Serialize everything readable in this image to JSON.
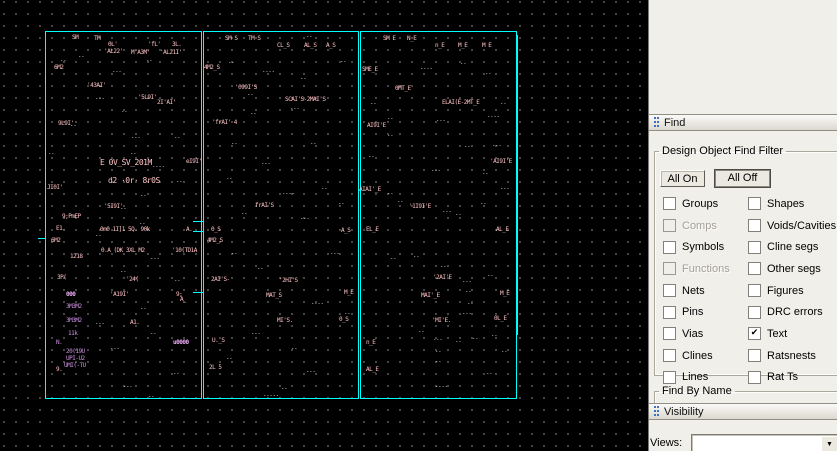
{
  "find": {
    "title": "Find",
    "group_title": "Design Object Find Filter",
    "all_on": "All On",
    "all_off": "All Off",
    "check_glyph": "✔",
    "rows": [
      {
        "left": {
          "label": "Groups",
          "checked": false
        },
        "right": {
          "label": "Shapes",
          "checked": false
        }
      },
      {
        "left": {
          "label": "Comps",
          "checked": false,
          "disabled": true
        },
        "right": {
          "label": "Voids/Cavities",
          "checked": false
        }
      },
      {
        "left": {
          "label": "Symbols",
          "checked": false
        },
        "right": {
          "label": "Cline segs",
          "checked": false
        }
      },
      {
        "left": {
          "label": "Functions",
          "checked": false,
          "disabled": true
        },
        "right": {
          "label": "Other segs",
          "checked": false
        }
      },
      {
        "left": {
          "label": "Nets",
          "checked": false
        },
        "right": {
          "label": "Figures",
          "checked": false
        }
      },
      {
        "left": {
          "label": "Pins",
          "checked": false
        },
        "right": {
          "label": "DRC errors",
          "checked": false
        }
      },
      {
        "left": {
          "label": "Vias",
          "checked": false
        },
        "right": {
          "label": "Text",
          "checked": true
        }
      },
      {
        "left": {
          "label": "Clines",
          "checked": false
        },
        "right": {
          "label": "Ratsnests",
          "checked": false
        }
      },
      {
        "left": {
          "label": "Lines",
          "checked": false
        },
        "right": {
          "label": "Rat Ts",
          "checked": false
        }
      }
    ],
    "find_by_name": "Find By Name"
  },
  "visibility": {
    "title": "Visibility",
    "views_label": "Views:",
    "views_value": ""
  },
  "canvas": {
    "bg": "#000000",
    "grid_dot_color": "#9f9f9f",
    "outline_color": "#00ffff",
    "rects": [
      {
        "x": 45,
        "y": 31,
        "w": 155,
        "h": 366
      },
      {
        "x": 203,
        "y": 31,
        "w": 154,
        "h": 366
      },
      {
        "x": 360,
        "y": 31,
        "w": 155,
        "h": 366
      }
    ],
    "ticks": [
      {
        "x": 193,
        "y": 221,
        "w": 10,
        "h": 1
      },
      {
        "x": 193,
        "y": 231,
        "w": 10,
        "h": 1
      },
      {
        "x": 193,
        "y": 292,
        "w": 10,
        "h": 1
      },
      {
        "x": 38,
        "y": 238,
        "w": 8,
        "h": 1
      },
      {
        "x": 517,
        "y": 35,
        "w": 1,
        "h": 300
      }
    ],
    "texts": [
      {
        "x": 72,
        "y": 35,
        "t": "SM",
        "c": "pink"
      },
      {
        "x": 94,
        "y": 36,
        "t": "TM",
        "c": "pink"
      },
      {
        "x": 108,
        "y": 42,
        "t": "0L'",
        "c": "pink"
      },
      {
        "x": 148,
        "y": 42,
        "t": "'fL'",
        "c": "pink"
      },
      {
        "x": 172,
        "y": 42,
        "t": "3L.",
        "c": "pink"
      },
      {
        "x": 104,
        "y": 49,
        "t": "'AL22'",
        "c": "pink"
      },
      {
        "x": 131,
        "y": 50,
        "t": "M'A3M'",
        "c": "pink"
      },
      {
        "x": 160,
        "y": 50,
        "t": "'AL21I'",
        "c": "pink"
      },
      {
        "x": 54,
        "y": 65,
        "t": "6M2",
        "c": "pink"
      },
      {
        "x": 87,
        "y": 83,
        "t": "'43AI'",
        "c": "pink"
      },
      {
        "x": 138,
        "y": 95,
        "t": "'5L9I'",
        "c": "pink"
      },
      {
        "x": 157,
        "y": 100,
        "t": "2I'AI'",
        "c": "pink"
      },
      {
        "x": 58,
        "y": 121,
        "t": "9L9I'",
        "c": "pink"
      },
      {
        "x": 100,
        "y": 160,
        "t": "E 0V_SV_201M",
        "c": "pink",
        "s": 8
      },
      {
        "x": 108,
        "y": 178,
        "t": "d2 ·0r· 8r0S",
        "c": "pink",
        "s": 8
      },
      {
        "x": 186,
        "y": 159,
        "t": "eI9I'",
        "c": "pink"
      },
      {
        "x": 47,
        "y": 185,
        "t": "JI0I'",
        "c": "pink"
      },
      {
        "x": 104,
        "y": 204,
        "t": "'5I9I'",
        "c": "pink"
      },
      {
        "x": 62,
        "y": 214,
        "t": "9;PmEP",
        "c": "pink"
      },
      {
        "x": 56,
        "y": 226,
        "t": "E1.",
        "c": "pink"
      },
      {
        "x": 51,
        "y": 238,
        "t": "6M2",
        "c": "pink"
      },
      {
        "x": 100,
        "y": 227,
        "t": "0m0 1I]1 5Q. 90k",
        "c": "pink"
      },
      {
        "x": 101,
        "y": 248,
        "t": "0.A (DK 3XL M2",
        "c": "pink"
      },
      {
        "x": 70,
        "y": 254,
        "t": "1218",
        "c": "pink"
      },
      {
        "x": 172,
        "y": 248,
        "t": "'10(TD1A",
        "c": "pink"
      },
      {
        "x": 186,
        "y": 227,
        "t": "A.",
        "c": "pink"
      },
      {
        "x": 57,
        "y": 275,
        "t": "3P(",
        "c": "pink"
      },
      {
        "x": 126,
        "y": 277,
        "t": "'24(",
        "c": "pink"
      },
      {
        "x": 110,
        "y": 292,
        "t": "'A19I'",
        "c": "pink"
      },
      {
        "x": 176,
        "y": 292,
        "t": "9;",
        "c": "pink"
      },
      {
        "x": 180,
        "y": 297,
        "t": "A_",
        "c": "pink"
      },
      {
        "x": 130,
        "y": 320,
        "t": "A1.",
        "c": "pink"
      },
      {
        "x": 56,
        "y": 367,
        "t": "9.",
        "c": "pink"
      },
      {
        "x": 66,
        "y": 292,
        "t": "000",
        "c": "lilac"
      },
      {
        "x": 66,
        "y": 304,
        "t": "3M3M2",
        "c": "purple"
      },
      {
        "x": 66,
        "y": 318,
        "t": "3M3M2",
        "c": "purple"
      },
      {
        "x": 68,
        "y": 331,
        "t": "11k",
        "c": "purple"
      },
      {
        "x": 56,
        "y": 340,
        "t": "N.",
        "c": "purple"
      },
      {
        "x": 66,
        "y": 349,
        "t": "20(19U",
        "c": "purple"
      },
      {
        "x": 66,
        "y": 356,
        "t": "UPI-U2",
        "c": "purple"
      },
      {
        "x": 64,
        "y": 363,
        "t": "UMI(-TU",
        "c": "purple"
      },
      {
        "x": 173,
        "y": 340,
        "t": "u0000",
        "c": "lilac"
      },
      {
        "x": 60,
        "y": 57,
        "t": "..",
        "c": "white"
      },
      {
        "x": 78,
        "y": 53,
        "t": "..",
        "c": "white"
      },
      {
        "x": 146,
        "y": 57,
        "t": "..",
        "c": "white"
      },
      {
        "x": 112,
        "y": 68,
        "t": "...",
        "c": "white"
      },
      {
        "x": 95,
        "y": 95,
        "t": "...",
        "c": "white"
      },
      {
        "x": 121,
        "y": 108,
        "t": "..",
        "c": "white"
      },
      {
        "x": 70,
        "y": 122,
        "t": "..",
        "c": "white"
      },
      {
        "x": 131,
        "y": 134,
        "t": "...",
        "c": "white"
      },
      {
        "x": 174,
        "y": 134,
        "t": "..",
        "c": "white"
      },
      {
        "x": 48,
        "y": 150,
        "t": "..",
        "c": "white"
      },
      {
        "x": 130,
        "y": 150,
        "t": "..",
        "c": "white"
      },
      {
        "x": 152,
        "y": 163,
        "t": "....",
        "c": "white"
      },
      {
        "x": 176,
        "y": 178,
        "t": "..",
        "c": "white"
      },
      {
        "x": 140,
        "y": 192,
        "t": "..",
        "c": "white"
      },
      {
        "x": 120,
        "y": 205,
        "t": "..",
        "c": "white"
      },
      {
        "x": 139,
        "y": 220,
        "t": "..",
        "c": "white"
      },
      {
        "x": 95,
        "y": 232,
        "t": "..",
        "c": "white"
      },
      {
        "x": 150,
        "y": 255,
        "t": "...",
        "c": "white"
      },
      {
        "x": 120,
        "y": 268,
        "t": "..",
        "c": "white"
      },
      {
        "x": 174,
        "y": 277,
        "t": "..",
        "c": "white"
      },
      {
        "x": 140,
        "y": 305,
        "t": "..",
        "c": "white"
      },
      {
        "x": 95,
        "y": 320,
        "t": "...",
        "c": "white"
      },
      {
        "x": 150,
        "y": 330,
        "t": "..",
        "c": "white"
      },
      {
        "x": 110,
        "y": 345,
        "t": "...",
        "c": "white"
      },
      {
        "x": 123,
        "y": 383,
        "t": "...",
        "c": "white"
      },
      {
        "x": 173,
        "y": 370,
        "t": "..",
        "c": "white"
      },
      {
        "x": 148,
        "y": 393,
        "t": "..",
        "c": "white"
      },
      {
        "x": 225,
        "y": 36,
        "t": "SM S",
        "c": "pink"
      },
      {
        "x": 248,
        "y": 36,
        "t": "TM S",
        "c": "pink"
      },
      {
        "x": 277,
        "y": 43,
        "t": "CL_S",
        "c": "pink"
      },
      {
        "x": 304,
        "y": 43,
        "t": "AL_S",
        "c": "pink"
      },
      {
        "x": 326,
        "y": 43,
        "t": "A_S",
        "c": "pink"
      },
      {
        "x": 204,
        "y": 65,
        "t": "4M2_S",
        "c": "pink"
      },
      {
        "x": 235,
        "y": 85,
        "t": "'099I'S",
        "c": "pink"
      },
      {
        "x": 285,
        "y": 97,
        "t": "SCAI'S-2MAI'S",
        "c": "pink"
      },
      {
        "x": 212,
        "y": 120,
        "t": "'frAI' 4",
        "c": "pink"
      },
      {
        "x": 255,
        "y": 203,
        "t": "frAI'S",
        "c": "pink"
      },
      {
        "x": 211,
        "y": 227,
        "t": "0_S",
        "c": "pink"
      },
      {
        "x": 207,
        "y": 238,
        "t": "4M2_S",
        "c": "pink"
      },
      {
        "x": 211,
        "y": 277,
        "t": "2AI'S-",
        "c": "pink"
      },
      {
        "x": 279,
        "y": 278,
        "t": "'2HI'S",
        "c": "pink"
      },
      {
        "x": 266,
        "y": 293,
        "t": "MAT_S",
        "c": "pink"
      },
      {
        "x": 277,
        "y": 318,
        "t": "MI'S.",
        "c": "pink"
      },
      {
        "x": 341,
        "y": 228,
        "t": "A_S",
        "c": "pink"
      },
      {
        "x": 344,
        "y": 290,
        "t": "M_E",
        "c": "pink"
      },
      {
        "x": 339,
        "y": 317,
        "t": "0_S",
        "c": "pink"
      },
      {
        "x": 212,
        "y": 338,
        "t": "U._S",
        "c": "pink"
      },
      {
        "x": 209,
        "y": 365,
        "t": "2L 5",
        "c": "pink"
      },
      {
        "x": 228,
        "y": 59,
        "t": "..",
        "c": "white"
      },
      {
        "x": 262,
        "y": 68,
        "t": "....",
        "c": "white"
      },
      {
        "x": 300,
        "y": 75,
        "t": "..",
        "c": "white"
      },
      {
        "x": 250,
        "y": 110,
        "t": "..",
        "c": "white"
      },
      {
        "x": 290,
        "y": 105,
        "t": "...",
        "c": "white"
      },
      {
        "x": 231,
        "y": 140,
        "t": "..",
        "c": "white"
      },
      {
        "x": 310,
        "y": 140,
        "t": "..",
        "c": "white"
      },
      {
        "x": 261,
        "y": 160,
        "t": "...",
        "c": "white"
      },
      {
        "x": 226,
        "y": 175,
        "t": "..",
        "c": "white"
      },
      {
        "x": 282,
        "y": 190,
        "t": "....",
        "c": "white"
      },
      {
        "x": 321,
        "y": 185,
        "t": "..",
        "c": "white"
      },
      {
        "x": 241,
        "y": 210,
        "t": "..",
        "c": "white"
      },
      {
        "x": 300,
        "y": 215,
        "t": "...",
        "c": "white"
      },
      {
        "x": 338,
        "y": 200,
        "t": "..",
        "c": "white"
      },
      {
        "x": 231,
        "y": 250,
        "t": "..",
        "c": "white"
      },
      {
        "x": 330,
        "y": 250,
        "t": "...",
        "c": "white"
      },
      {
        "x": 257,
        "y": 265,
        "t": "..",
        "c": "white"
      },
      {
        "x": 311,
        "y": 300,
        "t": "....",
        "c": "white"
      },
      {
        "x": 344,
        "y": 310,
        "t": "..",
        "c": "white"
      },
      {
        "x": 251,
        "y": 330,
        "t": "...",
        "c": "white"
      },
      {
        "x": 291,
        "y": 345,
        "t": "..",
        "c": "white"
      },
      {
        "x": 226,
        "y": 355,
        "t": "..",
        "c": "white"
      },
      {
        "x": 306,
        "y": 368,
        "t": "...",
        "c": "white"
      },
      {
        "x": 281,
        "y": 385,
        "t": "..",
        "c": "white"
      },
      {
        "x": 263,
        "y": 392,
        "t": ".....",
        "c": "white"
      },
      {
        "x": 306,
        "y": 33,
        "t": "..",
        "c": "white"
      },
      {
        "x": 340,
        "y": 58,
        "t": "..",
        "c": "white"
      },
      {
        "x": 247,
        "y": 91,
        "t": "..",
        "c": "white"
      },
      {
        "x": 383,
        "y": 36,
        "t": "SM E",
        "c": "pink"
      },
      {
        "x": 407,
        "y": 36,
        "t": "N_E",
        "c": "pink"
      },
      {
        "x": 435,
        "y": 43,
        "t": "n_E",
        "c": "pink"
      },
      {
        "x": 458,
        "y": 43,
        "t": "M_E",
        "c": "pink"
      },
      {
        "x": 482,
        "y": 43,
        "t": "M E",
        "c": "pink"
      },
      {
        "x": 362,
        "y": 67,
        "t": "SME_E",
        "c": "pink"
      },
      {
        "x": 395,
        "y": 86,
        "t": "0MT_E",
        "c": "pink"
      },
      {
        "x": 442,
        "y": 100,
        "t": "ELAI(E-2MT_E",
        "c": "pink"
      },
      {
        "x": 367,
        "y": 123,
        "t": "AI9I'E",
        "c": "pink"
      },
      {
        "x": 490,
        "y": 159,
        "t": "'AI9I'E",
        "c": "pink"
      },
      {
        "x": 359,
        "y": 187,
        "t": "AIAI'_E",
        "c": "pink"
      },
      {
        "x": 409,
        "y": 204,
        "t": "'1I9I'E",
        "c": "pink"
      },
      {
        "x": 366,
        "y": 227,
        "t": "EL_E",
        "c": "pink"
      },
      {
        "x": 496,
        "y": 227,
        "t": "AL_E",
        "c": "pink"
      },
      {
        "x": 433,
        "y": 275,
        "t": "'2AI'E",
        "c": "pink"
      },
      {
        "x": 421,
        "y": 293,
        "t": "MAI'_E",
        "c": "pink"
      },
      {
        "x": 432,
        "y": 318,
        "t": "'MI'E.",
        "c": "pink"
      },
      {
        "x": 500,
        "y": 291,
        "t": "M_E",
        "c": "pink"
      },
      {
        "x": 494,
        "y": 316,
        "t": "0L_E",
        "c": "pink"
      },
      {
        "x": 366,
        "y": 340,
        "t": "n_E",
        "c": "pink"
      },
      {
        "x": 366,
        "y": 367,
        "t": "AL_E",
        "c": "pink"
      },
      {
        "x": 387,
        "y": 115,
        "t": "..",
        "c": "white"
      },
      {
        "x": 436,
        "y": 117,
        "t": "...",
        "c": "white"
      },
      {
        "x": 487,
        "y": 113,
        "t": "....",
        "c": "white"
      },
      {
        "x": 387,
        "y": 132,
        "t": "..",
        "c": "white"
      },
      {
        "x": 464,
        "y": 143,
        "t": "..",
        "c": "white"
      },
      {
        "x": 492,
        "y": 142,
        "t": "...",
        "c": "white"
      },
      {
        "x": 368,
        "y": 153,
        "t": "..",
        "c": "white"
      },
      {
        "x": 431,
        "y": 167,
        "t": "...",
        "c": "white"
      },
      {
        "x": 482,
        "y": 170,
        "t": "..",
        "c": "white"
      },
      {
        "x": 387,
        "y": 190,
        "t": "..",
        "c": "white"
      },
      {
        "x": 397,
        "y": 198,
        "t": "..",
        "c": "white"
      },
      {
        "x": 442,
        "y": 208,
        "t": "...",
        "c": "white"
      },
      {
        "x": 480,
        "y": 200,
        "t": "..",
        "c": "white"
      },
      {
        "x": 413,
        "y": 253,
        "t": "..",
        "c": "white"
      },
      {
        "x": 440,
        "y": 263,
        "t": "..",
        "c": "white"
      },
      {
        "x": 462,
        "y": 278,
        "t": "...",
        "c": "white"
      },
      {
        "x": 487,
        "y": 272,
        "t": "..",
        "c": "white"
      },
      {
        "x": 465,
        "y": 288,
        "t": "..",
        "c": "white"
      },
      {
        "x": 467,
        "y": 300,
        "t": "..",
        "c": "white"
      },
      {
        "x": 462,
        "y": 310,
        "t": "...",
        "c": "white"
      },
      {
        "x": 418,
        "y": 328,
        "t": "..",
        "c": "white"
      },
      {
        "x": 472,
        "y": 335,
        "t": "..",
        "c": "white"
      },
      {
        "x": 433,
        "y": 336,
        "t": "...",
        "c": "white"
      },
      {
        "x": 455,
        "y": 338,
        "t": "..",
        "c": "white"
      },
      {
        "x": 491,
        "y": 332,
        "t": "..",
        "c": "white"
      },
      {
        "x": 435,
        "y": 348,
        "t": "..",
        "c": "white"
      },
      {
        "x": 501,
        "y": 348,
        "t": "..",
        "c": "white"
      },
      {
        "x": 435,
        "y": 358,
        "t": "..",
        "c": "white"
      },
      {
        "x": 486,
        "y": 370,
        "t": "..",
        "c": "white"
      },
      {
        "x": 435,
        "y": 383,
        "t": "....",
        "c": "white"
      },
      {
        "x": 420,
        "y": 65,
        "t": "....",
        "c": "white"
      },
      {
        "x": 460,
        "y": 60,
        "t": "..",
        "c": "white"
      },
      {
        "x": 485,
        "y": 70,
        "t": "..",
        "c": "white"
      },
      {
        "x": 370,
        "y": 100,
        "t": "..",
        "c": "white"
      },
      {
        "x": 500,
        "y": 100,
        "t": "..",
        "c": "white"
      },
      {
        "x": 500,
        "y": 185,
        "t": "...",
        "c": "white"
      },
      {
        "x": 455,
        "y": 211,
        "t": "..",
        "c": "white"
      },
      {
        "x": 390,
        "y": 255,
        "t": "..",
        "c": "white"
      }
    ]
  }
}
